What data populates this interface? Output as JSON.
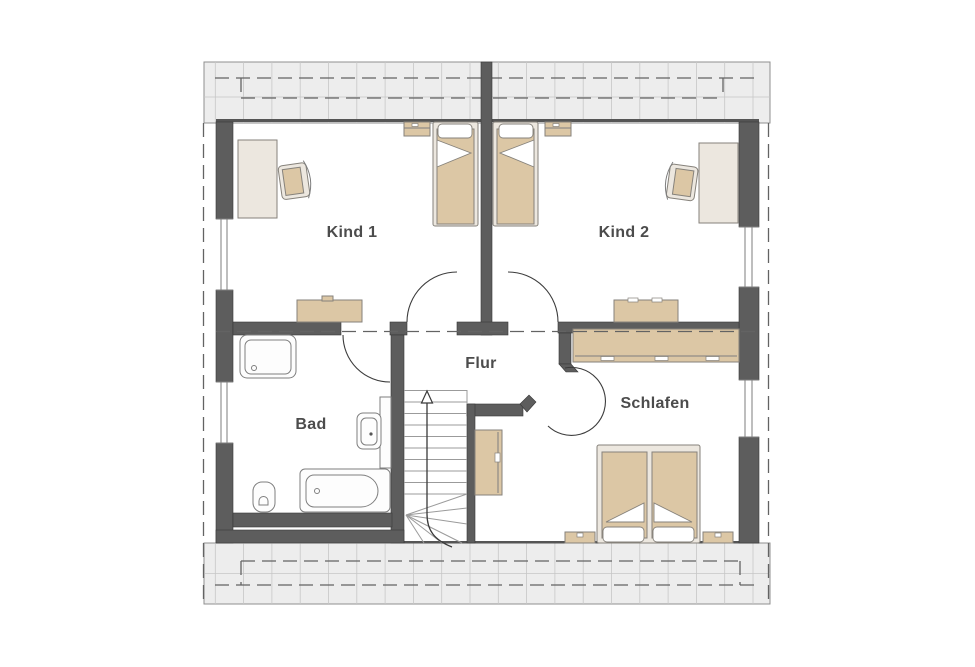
{
  "rooms": {
    "kind1": {
      "label": "Kind 1"
    },
    "kind2": {
      "label": "Kind 2"
    },
    "flur": {
      "label": "Flur"
    },
    "bad": {
      "label": "Bad"
    },
    "schlafen": {
      "label": "Schlafen"
    }
  },
  "colors": {
    "wall": "#5d5d5d",
    "wall_outline": "#383838",
    "roof_hatch_fill": "#ededed",
    "roof_grid_line": "#c6c6c6",
    "hatch_border": "#8f8f8f",
    "furniture_tan": "#dcc7a5",
    "furniture_cream": "#ece7df",
    "furniture_outline": "#86827b",
    "fixture_white": "#fdfdfd",
    "fixture_outline": "#7e7e7e",
    "dash_line": "#636363",
    "step_line": "#9b9b9b",
    "walkline": "#3a3a3a",
    "label_text": "#4c4c4c",
    "background": "#ffffff"
  }
}
